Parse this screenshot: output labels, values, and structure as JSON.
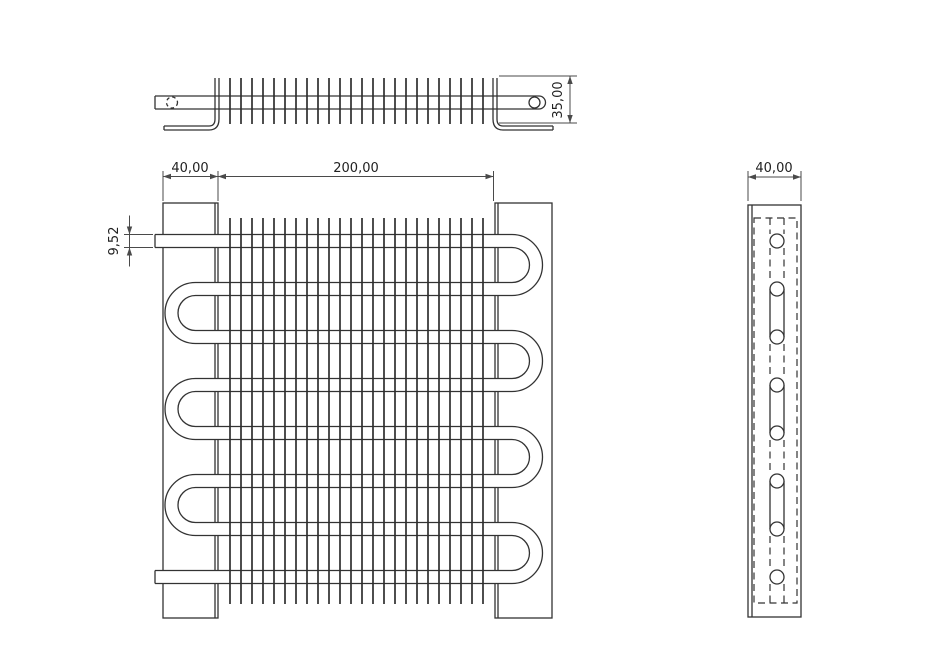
{
  "dimensions": {
    "front_plate_width": "40,00",
    "front_fin_length": "200,00",
    "front_tube_diameter": "9,52",
    "top_fin_depth": "35,00",
    "side_plate_width": "40,00"
  },
  "colors": {
    "line": "#333333",
    "dimension_line": "#4a4a4a",
    "text": "#222222",
    "background": "#ffffff"
  },
  "geometry": {
    "front": {
      "left_plate": [
        163,
        203,
        55,
        415
      ],
      "left_plate_inner_x": 215,
      "right_plate": [
        495,
        203,
        57,
        415
      ],
      "right_plate_inner_x": 498,
      "fins": {
        "count": 24,
        "x0": 230,
        "dx": 11,
        "y0": 218,
        "y1": 604
      },
      "tube": {
        "y_centers": [
          241,
          289,
          337,
          385,
          433,
          481,
          529,
          577
        ],
        "half": 6.5,
        "outer_r": 30.5,
        "inner_r": 17.5,
        "x_stub": 155,
        "x_left": 195.5,
        "x_right": 512,
        "right_pairs": [
          [
            0,
            1
          ],
          [
            2,
            3
          ],
          [
            4,
            5
          ],
          [
            6,
            7
          ]
        ],
        "left_pairs": [
          [
            1,
            2
          ],
          [
            3,
            4
          ],
          [
            5,
            6
          ]
        ]
      },
      "dims": {
        "ext_y0": 171,
        "ext_y1": 201,
        "dim_y": 176.5,
        "x_a": 163,
        "x_b": 218,
        "x_c": 493.5,
        "d952": {
          "ext_x0": 124,
          "ext_x1": 153,
          "dim_x": 129.5,
          "y_top": 234.5,
          "y_bot": 247.5,
          "over": 19
        }
      }
    },
    "top": {
      "tube_x0": 155,
      "tube_x1": 539,
      "tube_y_top": 96,
      "tube_y_bot": 109,
      "cap_r": 6.5,
      "circle_solid": [
        534.5,
        102.5,
        5.5
      ],
      "circle_dashed": [
        172,
        102.5,
        5.5
      ],
      "fins": {
        "count": 24,
        "x0": 230,
        "dx": 11,
        "y0": 78,
        "y1": 124
      },
      "left_bracket": {
        "xi": 215,
        "xo": 219,
        "y0": 78,
        "yb": 119,
        "fy1": 126,
        "fy2": 130,
        "fx": 164,
        "s": -1
      },
      "right_bracket": {
        "xi": 497,
        "xo": 493,
        "y0": 78,
        "yb": 119,
        "fy1": 126,
        "fy2": 130,
        "fx": 553,
        "s": 1
      },
      "dim35": {
        "ext_x0": 499,
        "ext_x1": 577,
        "ext_y_top": 76,
        "ext_y_bot": 123,
        "dim_x": 570
      }
    },
    "side": {
      "plate": [
        748,
        205,
        53,
        412
      ],
      "inner_x": 752,
      "dashed_rect": [
        754,
        218,
        43,
        385
      ],
      "circles_x": 777,
      "circle_r": 7,
      "circles_y": [
        241,
        289,
        337,
        385,
        433,
        481,
        529,
        577
      ],
      "tan_dx": 7,
      "solid_pairs": [
        [
          1,
          2
        ],
        [
          3,
          4
        ],
        [
          5,
          6
        ]
      ],
      "dashed_pairs": [
        [
          0,
          1
        ],
        [
          2,
          3
        ],
        [
          4,
          5
        ],
        [
          6,
          7
        ]
      ],
      "stub_top_y": 218,
      "stub_bot_y": 603,
      "dim40": {
        "x0": 748,
        "x1": 801,
        "ext_y0": 171,
        "ext_y1": 201,
        "dim_y": 177
      }
    }
  }
}
